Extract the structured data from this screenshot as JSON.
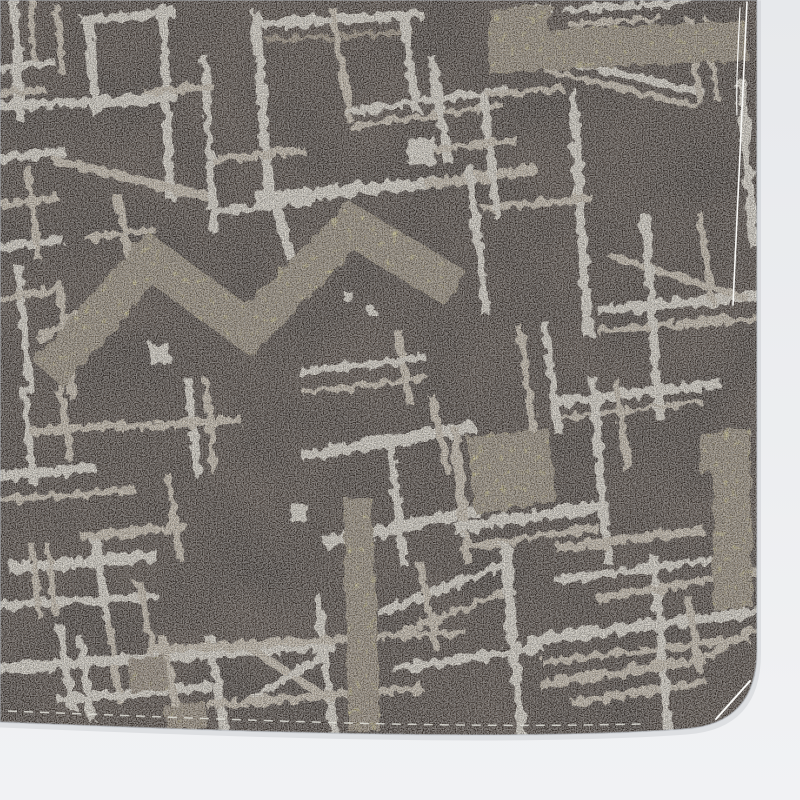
{
  "meta": {
    "subject": "photograph of a fabric swatch",
    "pattern_style": "abstract cream brushstroke grid with yellow zigzag accents on dark brown crepe",
    "canvas": {
      "width": 800,
      "height": 800
    }
  },
  "palette": {
    "photo_background_top": "#e7e9ec",
    "photo_background_bottom": "#f1f2f4",
    "fabric_brown": "#4a3d34",
    "stroke_cream_bright": "#eae3d5",
    "stroke_cream_dim": "#cfc2ae",
    "stroke_accent_dark": "#9a8b76",
    "accent_yellow": "#d5ca82",
    "accent_yellow_dim": "#b9ae77",
    "thread_white": "#f8f8f6",
    "stitch": "#e2e2da",
    "edge_shadow": "#b9bec4"
  },
  "fabric": {
    "outline_path": "M0,0 L757,0 L757,650 Q757,724 685,729 C520,741 260,733 0,722 Z"
  },
  "pattern": {
    "stroke_color_keys": {
      "a": "stroke_cream_bright",
      "b": "stroke_cream_dim",
      "d": "stroke_accent_dark"
    },
    "strokes": [
      [
        14,
        2,
        20,
        116,
        9,
        "a"
      ],
      [
        31,
        0,
        34,
        58,
        6,
        "b"
      ],
      [
        0,
        68,
        50,
        62,
        8,
        "a"
      ],
      [
        0,
        94,
        42,
        89,
        7,
        "b"
      ],
      [
        57,
        8,
        62,
        70,
        7,
        "b"
      ],
      [
        88,
        20,
        96,
        112,
        9,
        "a"
      ],
      [
        163,
        10,
        170,
        196,
        9,
        "a"
      ],
      [
        85,
        20,
        172,
        13,
        9,
        "a"
      ],
      [
        0,
        106,
        172,
        98,
        10,
        "a"
      ],
      [
        0,
        158,
        62,
        152,
        9,
        "a"
      ],
      [
        58,
        161,
        205,
        196,
        9,
        "b"
      ],
      [
        205,
        60,
        214,
        228,
        8,
        "a"
      ],
      [
        148,
        92,
        210,
        87,
        7,
        "b"
      ],
      [
        0,
        205,
        55,
        198,
        8,
        "b"
      ],
      [
        0,
        247,
        60,
        240,
        8,
        "a"
      ],
      [
        28,
        170,
        38,
        258,
        7,
        "b"
      ],
      [
        256,
        16,
        270,
        204,
        10,
        "a"
      ],
      [
        260,
        24,
        418,
        15,
        10,
        "a"
      ],
      [
        268,
        40,
        410,
        32,
        5,
        "d"
      ],
      [
        404,
        16,
        416,
        108,
        9,
        "a"
      ],
      [
        333,
        12,
        350,
        118,
        8,
        "b"
      ],
      [
        350,
        112,
        505,
        90,
        7,
        "a"
      ],
      [
        352,
        127,
        500,
        105,
        6,
        "b"
      ],
      [
        262,
        198,
        432,
        183,
        12,
        "a"
      ],
      [
        430,
        184,
        532,
        170,
        10,
        "b"
      ],
      [
        214,
        160,
        300,
        150,
        8,
        "b"
      ],
      [
        218,
        212,
        312,
        200,
        8,
        "a"
      ],
      [
        277,
        206,
        290,
        256,
        9,
        "a"
      ],
      [
        498,
        16,
        548,
        8,
        8,
        "a"
      ],
      [
        432,
        60,
        448,
        160,
        9,
        "a"
      ],
      [
        545,
        56,
        700,
        92,
        8,
        "a"
      ],
      [
        548,
        71,
        695,
        106,
        6,
        "b"
      ],
      [
        573,
        95,
        588,
        332,
        10,
        "a"
      ],
      [
        741,
        84,
        754,
        243,
        10,
        "a"
      ],
      [
        690,
        20,
        700,
        100,
        7,
        "b"
      ],
      [
        707,
        22,
        716,
        98,
        6,
        "b"
      ],
      [
        566,
        10,
        688,
        2,
        7,
        "a"
      ],
      [
        570,
        24,
        660,
        18,
        5,
        "b"
      ],
      [
        488,
        95,
        560,
        88,
        7,
        "b"
      ],
      [
        602,
        310,
        756,
        296,
        10,
        "a"
      ],
      [
        600,
        330,
        756,
        318,
        7,
        "b"
      ],
      [
        612,
        256,
        745,
        298,
        7,
        "b"
      ],
      [
        645,
        218,
        660,
        415,
        9,
        "a"
      ],
      [
        700,
        216,
        712,
        300,
        7,
        "b"
      ],
      [
        556,
        402,
        716,
        384,
        10,
        "a"
      ],
      [
        560,
        418,
        700,
        402,
        5,
        "b"
      ],
      [
        470,
        170,
        486,
        312,
        9,
        "a"
      ],
      [
        486,
        208,
        590,
        198,
        7,
        "b"
      ],
      [
        520,
        330,
        534,
        432,
        8,
        "b"
      ],
      [
        545,
        325,
        558,
        430,
        8,
        "a"
      ],
      [
        484,
        98,
        497,
        214,
        8,
        "a"
      ],
      [
        433,
        150,
        515,
        140,
        7,
        "b"
      ],
      [
        308,
        455,
        468,
        428,
        12,
        "a"
      ],
      [
        390,
        442,
        404,
        562,
        9,
        "a"
      ],
      [
        330,
        542,
        472,
        512,
        12,
        "a"
      ],
      [
        455,
        432,
        468,
        560,
        9,
        "b"
      ],
      [
        432,
        398,
        448,
        468,
        8,
        "b"
      ],
      [
        460,
        528,
        600,
        506,
        12,
        "a"
      ],
      [
        462,
        548,
        596,
        528,
        7,
        "b"
      ],
      [
        593,
        382,
        608,
        560,
        9,
        "a"
      ],
      [
        616,
        382,
        628,
        470,
        7,
        "b"
      ],
      [
        560,
        548,
        700,
        530,
        9,
        "b"
      ],
      [
        382,
        612,
        498,
        566,
        9,
        "a"
      ],
      [
        390,
        636,
        505,
        592,
        7,
        "b"
      ],
      [
        24,
        392,
        34,
        482,
        8,
        "a"
      ],
      [
        60,
        386,
        70,
        458,
        7,
        "b"
      ],
      [
        0,
        477,
        90,
        468,
        10,
        "a"
      ],
      [
        0,
        500,
        132,
        490,
        7,
        "b"
      ],
      [
        35,
        432,
        122,
        424,
        8,
        "b"
      ],
      [
        188,
        382,
        198,
        472,
        8,
        "a"
      ],
      [
        206,
        382,
        214,
        470,
        6,
        "b"
      ],
      [
        120,
        428,
        238,
        420,
        8,
        "b"
      ],
      [
        15,
        568,
        152,
        556,
        12,
        "a"
      ],
      [
        95,
        540,
        107,
        620,
        9,
        "a"
      ],
      [
        85,
        536,
        182,
        527,
        8,
        "b"
      ],
      [
        0,
        606,
        152,
        596,
        9,
        "a"
      ],
      [
        140,
        586,
        152,
        648,
        8,
        "b"
      ],
      [
        32,
        546,
        40,
        616,
        6,
        "b"
      ],
      [
        48,
        546,
        55,
        612,
        6,
        "b"
      ],
      [
        168,
        476,
        180,
        556,
        7,
        "b"
      ],
      [
        60,
        628,
        72,
        706,
        8,
        "a"
      ],
      [
        108,
        622,
        120,
        700,
        7,
        "b"
      ],
      [
        0,
        668,
        330,
        646,
        10,
        "a"
      ],
      [
        62,
        700,
        208,
        686,
        9,
        "a"
      ],
      [
        210,
        640,
        225,
        732,
        9,
        "a"
      ],
      [
        250,
        648,
        330,
        700,
        8,
        "b"
      ],
      [
        252,
        700,
        332,
        648,
        8,
        "a"
      ],
      [
        318,
        600,
        334,
        734,
        9,
        "a"
      ],
      [
        150,
        650,
        462,
        632,
        8,
        "b"
      ],
      [
        210,
        705,
        420,
        688,
        8,
        "b"
      ],
      [
        420,
        565,
        436,
        645,
        8,
        "b"
      ],
      [
        398,
        668,
        540,
        648,
        10,
        "a"
      ],
      [
        505,
        548,
        522,
        736,
        10,
        "a"
      ],
      [
        532,
        640,
        757,
        612,
        11,
        "a"
      ],
      [
        545,
        662,
        745,
        638,
        7,
        "b"
      ],
      [
        576,
        702,
        702,
        682,
        8,
        "b"
      ],
      [
        654,
        560,
        668,
        726,
        9,
        "a"
      ],
      [
        688,
        598,
        700,
        668,
        7,
        "b"
      ],
      [
        600,
        598,
        756,
        572,
        8,
        "b"
      ],
      [
        558,
        580,
        740,
        556,
        7,
        "a"
      ],
      [
        700,
        660,
        752,
        630,
        8,
        "b"
      ],
      [
        543,
        684,
        702,
        660,
        9,
        "b"
      ],
      [
        40,
        338,
        108,
        296,
        8,
        "b"
      ],
      [
        60,
        286,
        72,
        396,
        7,
        "b"
      ],
      [
        18,
        268,
        30,
        390,
        8,
        "a"
      ],
      [
        0,
        300,
        60,
        288,
        7,
        "b"
      ],
      [
        118,
        198,
        130,
        258,
        8,
        "b"
      ],
      [
        88,
        238,
        152,
        230,
        7,
        "b"
      ],
      [
        398,
        332,
        410,
        402,
        7,
        "b"
      ],
      [
        302,
        372,
        422,
        358,
        8,
        "a"
      ],
      [
        306,
        392,
        424,
        378,
        6,
        "b"
      ],
      [
        80,
        640,
        92,
        718,
        8,
        "a"
      ],
      [
        163,
        640,
        176,
        706,
        8,
        "b"
      ]
    ],
    "yellow_shapes": [
      {
        "kind": "zigzag",
        "points": [
          [
            48,
            374
          ],
          [
            150,
            258
          ],
          [
            248,
            330
          ],
          [
            352,
            226
          ],
          [
            455,
            288
          ]
        ],
        "width": 40
      },
      {
        "kind": "polygon",
        "points": [
          [
            488,
            74
          ],
          [
            490,
            10
          ],
          [
            552,
            4
          ],
          [
            548,
            30
          ],
          [
            745,
            21
          ],
          [
            748,
            60
          ],
          [
            542,
            70
          ]
        ]
      },
      {
        "kind": "polygon",
        "points": [
          [
            467,
            437
          ],
          [
            548,
            428
          ],
          [
            556,
            502
          ],
          [
            476,
            514
          ]
        ]
      },
      {
        "kind": "polygon",
        "points": [
          [
            700,
            434
          ],
          [
            750,
            428
          ],
          [
            752,
            606
          ],
          [
            714,
            610
          ],
          [
            712,
            472
          ],
          [
            700,
            474
          ]
        ]
      },
      {
        "kind": "polygon",
        "points": [
          [
            344,
            498
          ],
          [
            372,
            498
          ],
          [
            380,
            730
          ],
          [
            348,
            732
          ]
        ]
      },
      {
        "kind": "polygon",
        "points": [
          [
            165,
            706
          ],
          [
            205,
            702
          ],
          [
            207,
            728
          ],
          [
            166,
            730
          ]
        ]
      },
      {
        "kind": "polygon",
        "points": [
          [
            128,
            660
          ],
          [
            165,
            655
          ],
          [
            168,
            690
          ],
          [
            131,
            694
          ]
        ],
        "dim": true
      }
    ],
    "white_squares": [
      {
        "x": 408,
        "y": 137,
        "s": 27,
        "r": 4
      },
      {
        "x": 150,
        "y": 344,
        "s": 20,
        "r": -3
      },
      {
        "x": 290,
        "y": 504,
        "s": 17,
        "r": 3
      },
      {
        "x": 344,
        "y": 292,
        "s": 9,
        "r": 0
      },
      {
        "x": 366,
        "y": 306,
        "s": 8,
        "r": 0
      }
    ],
    "threads": [
      {
        "d": "M747,2 C743,70 739,160 733,305",
        "w": 1.6
      },
      {
        "d": "M740,8 C738,50 736,85 737,115",
        "w": 1.2
      },
      {
        "d": "M716,719 L750,681",
        "w": 2
      }
    ],
    "stitch_lines": [
      {
        "d": "M8,711 C220,719 430,729 642,724",
        "w": 1.5,
        "dash": "9 7"
      }
    ]
  }
}
